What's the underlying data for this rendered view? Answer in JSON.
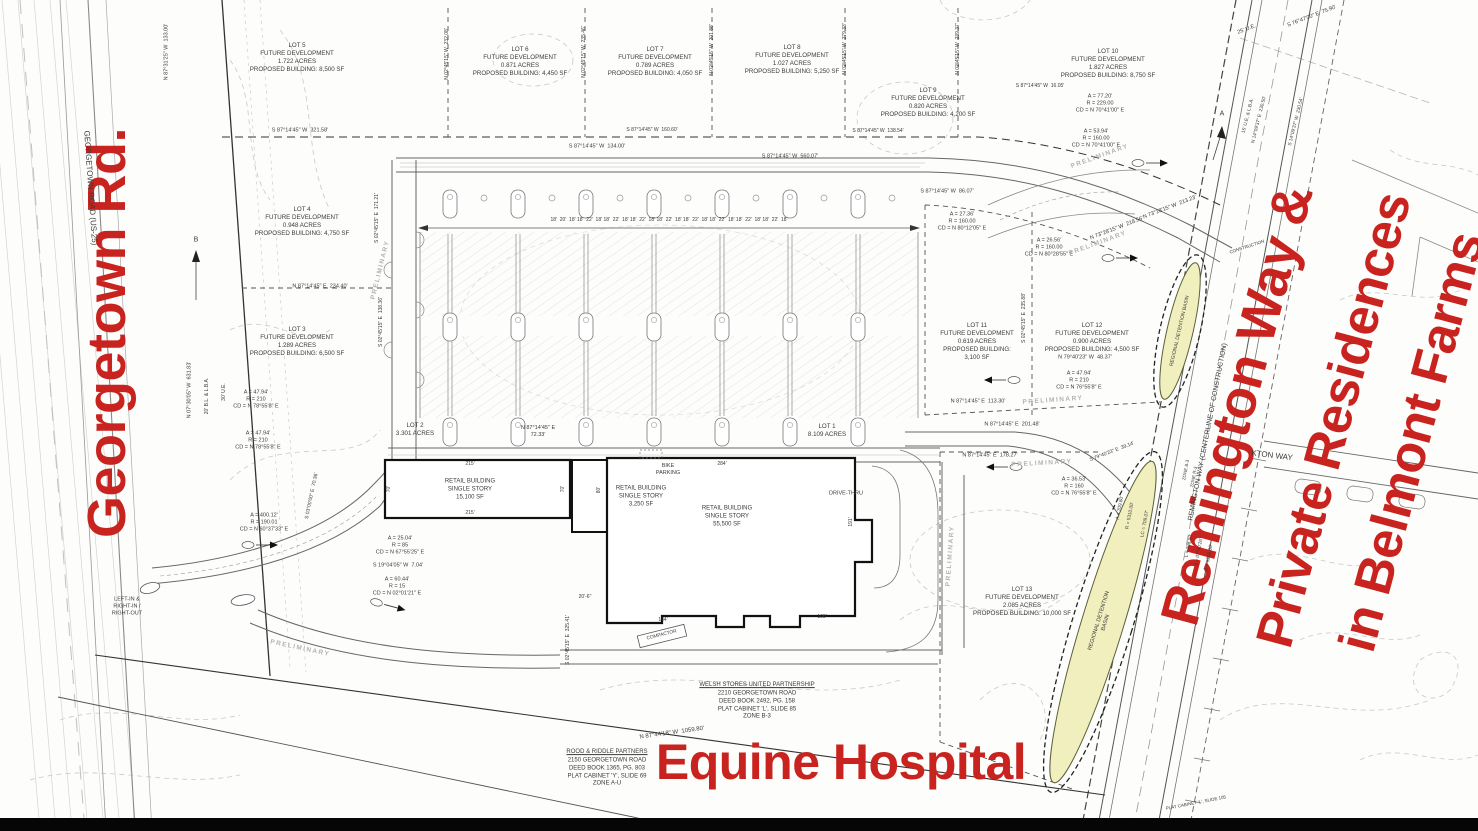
{
  "annotations": {
    "georgetown": "Georgetown Rd.",
    "remington_1": "Remington Way &",
    "remington_2": "Private Residences",
    "remington_3": "in Belmont Farms",
    "equine": "Equine Hospital",
    "color": "#c8231e"
  },
  "texts": [
    {
      "n": "road-label-georgetown",
      "t": "GEORGETOWN ROAD (US-25)",
      "x": 90,
      "y": 188,
      "r": 86,
      "s": 8
    },
    {
      "n": "road-label-remington",
      "t": "REMINGTON WAY (CENTERLINE OF CONSTRUCTION)",
      "x": 1208,
      "y": 432,
      "r": -79,
      "s": 7
    },
    {
      "n": "road-label-side-street",
      "t": "KTON WAY",
      "x": 1272,
      "y": 456,
      "r": 7,
      "s": 8
    },
    {
      "n": "lot5-label",
      "t": "LOT 5\nFUTURE DEVELOPMENT\n1.722 ACRES\nPROPOSED BUILDING: 8,500 SF",
      "x": 297,
      "y": 58
    },
    {
      "n": "lot6-label",
      "t": "LOT 6\nFUTURE DEVELOPMENT\n0.871 ACRES\nPROPOSED BUILDING: 4,450 SF",
      "x": 520,
      "y": 62
    },
    {
      "n": "lot7-label",
      "t": "LOT 7\nFUTURE DEVELOPMENT\n0.789 ACRES\nPROPOSED BUILDING: 4,050 SF",
      "x": 655,
      "y": 62
    },
    {
      "n": "lot8-label",
      "t": "LOT 8\nFUTURE DEVELOPMENT\n1.027 ACRES\nPROPOSED BUILDING: 5,250 SF",
      "x": 792,
      "y": 60
    },
    {
      "n": "lot9-label",
      "t": "LOT 9\nFUTURE DEVELOPMENT\n0.820 ACRES\nPROPOSED BUILDING: 4,200 SF",
      "x": 928,
      "y": 103
    },
    {
      "n": "lot10-label",
      "t": "LOT 10\nFUTURE DEVELOPMENT\n1.827 ACRES\nPROPOSED BUILDING: 8,750 SF",
      "x": 1108,
      "y": 64
    },
    {
      "n": "lot4-label",
      "t": "LOT 4\nFUTURE DEVELOPMENT\n0.948 ACRES\nPROPOSED BUILDING: 4,750 SF",
      "x": 302,
      "y": 222
    },
    {
      "n": "lot3-label",
      "t": "LOT 3\nFUTURE DEVELOPMENT\n1.289 ACRES\nPROPOSED BUILDING: 6,500 SF",
      "x": 297,
      "y": 342
    },
    {
      "n": "lot11-label",
      "t": "LOT 11\nFUTURE DEVELOPMENT\n0.619 ACRES\nPROPOSED BUILDING:\n3,100 SF",
      "x": 977,
      "y": 342
    },
    {
      "n": "lot12-label",
      "t": "LOT 12\nFUTURE DEVELOPMENT\n0.900 ACRES\nPROPOSED BUILDING: 4,500 SF",
      "x": 1092,
      "y": 338
    },
    {
      "n": "lot13-label",
      "t": "LOT 13\nFUTURE DEVELOPMENT\n2.085 ACRES\nPROPOSED BUILDING: 10,000 SF",
      "x": 1022,
      "y": 602
    },
    {
      "n": "lot2-label",
      "t": "LOT 2\n3.301 ACRES",
      "x": 415,
      "y": 430
    },
    {
      "n": "lot1-label",
      "t": "LOT 1\n8.109 ACRES",
      "x": 827,
      "y": 431
    },
    {
      "n": "building1-label",
      "t": "RETAIL BUILDING\nSINGLE STORY\n15,100 SF",
      "x": 470,
      "y": 490,
      "s": 6
    },
    {
      "n": "building2-label",
      "t": "RETAIL BUILDING\nSINGLE STORY\n3,250 SF",
      "x": 641,
      "y": 497,
      "s": 6
    },
    {
      "n": "building3-label",
      "t": "RETAIL BUILDING\nSINGLE STORY\n55,500 SF",
      "x": 727,
      "y": 517,
      "s": 6
    },
    {
      "n": "bike-parking-label",
      "t": "BIKE\nPARKING",
      "x": 668,
      "y": 470,
      "s": 5.5
    },
    {
      "n": "drive-thru-label",
      "t": "DRIVE-THRU",
      "x": 846,
      "y": 494,
      "s": 5.5
    },
    {
      "n": "compactor-label",
      "t": "COMPACTOR",
      "x": 662,
      "y": 636,
      "r": -14,
      "s": 4.8
    },
    {
      "n": "left-in-right-out-label",
      "t": "LEFT-IN &\nRIGHT-IN /\nRIGHT-OUT",
      "x": 127,
      "y": 607,
      "s": 5.5
    },
    {
      "n": "owner-a-title",
      "t": "WELSH STORES UNITED PARTNERSHIP",
      "x": 757,
      "y": 686,
      "s": 6,
      "u": 1
    },
    {
      "n": "owner-a-body",
      "t": "2210 GEORGETOWN ROAD\nDEED BOOK 2492, PG. 158\nPLAT CABINET 'L', SLIDE 85\nZONE B-3",
      "x": 757,
      "y": 706,
      "s": 6
    },
    {
      "n": "owner-b-title",
      "t": "ROOD & RIDDLE PARTNERS",
      "x": 607,
      "y": 753,
      "s": 6,
      "u": 1
    },
    {
      "n": "owner-b-body",
      "t": "2150 GEORGETOWN ROAD\nDEED BOOK 1365, PG. 803\nPLAT CABINET 'Y', SLIDE 69\nZONE A-U",
      "x": 607,
      "y": 773,
      "s": 6
    },
    {
      "n": "basin1-label",
      "t": "REGIONAL DETENTION BASIN",
      "x": 1180,
      "y": 331,
      "r": -77,
      "s": 5
    },
    {
      "n": "basin2-label",
      "t": "REGIONAL DETENTION\nBASIN",
      "x": 1103,
      "y": 622,
      "r": -73,
      "s": 5.5
    },
    {
      "n": "parking-dim-string",
      "t": "18'  20'  18' 18'  22'  18' 18'  22'  18' 18'  22'  18' 18'  22'  18' 18'  22'  18' 18'  22'  18' 18'  22'  18' 18'  22'  18'",
      "x": 669,
      "y": 220,
      "s": 5
    },
    {
      "n": "dim-13300",
      "t": "N 87°31'25\" W  133.00'",
      "x": 167,
      "y": 52,
      "r": -90,
      "s": 5.5
    },
    {
      "n": "dim-63183",
      "t": "N 07°30'05\" W  631.83'",
      "x": 190,
      "y": 390,
      "r": -90,
      "s": 5.5
    },
    {
      "n": "dim-bl-lba",
      "t": "20' B.L. & L.B.A.",
      "x": 207,
      "y": 396,
      "r": -90,
      "s": 5
    },
    {
      "n": "dim-30-ue",
      "t": "30' U.E.",
      "x": 224,
      "y": 392,
      "r": -90,
      "s": 5
    },
    {
      "n": "dim-32158",
      "t": "S 87°14'45\" W  321.58'",
      "x": 300,
      "y": 131,
      "s": 5.5
    },
    {
      "n": "dim-13400",
      "t": "S 87°14'45\" W  134.00'",
      "x": 597,
      "y": 147,
      "s": 5.5
    },
    {
      "n": "dim-56007",
      "t": "S 87°14'45\" W  560.07'",
      "x": 790,
      "y": 157,
      "s": 5.5
    },
    {
      "n": "dim-16060",
      "t": "S 87°14'45\" W  160.60'",
      "x": 652,
      "y": 130,
      "s": 5
    },
    {
      "n": "dim-13854",
      "t": "S 87°14'45\" W  138.54'",
      "x": 878,
      "y": 131,
      "s": 5
    },
    {
      "n": "dim-23208",
      "t": "N 02°45'15\" W  232.08'",
      "x": 447,
      "y": 54,
      "r": -90,
      "s": 5
    },
    {
      "n": "dim-23546",
      "t": "N 02°45'15\" W  235.46'",
      "x": 584,
      "y": 52,
      "r": -90,
      "s": 5
    },
    {
      "n": "dim-20188",
      "t": "N 02°45'15\" W  201.88'",
      "x": 712,
      "y": 50,
      "r": -90,
      "s": 5
    },
    {
      "n": "dim-27933",
      "t": "N 02°45'15\" W  279.33'",
      "x": 845,
      "y": 49,
      "r": -90,
      "s": 5
    },
    {
      "n": "dim-23937",
      "t": "N 02°45'15\" W  239.37'",
      "x": 958,
      "y": 49,
      "r": -90,
      "s": 5
    },
    {
      "n": "dim-23440",
      "t": "N 87°14'45\" E  234.40'",
      "x": 320,
      "y": 287,
      "s": 5.5
    },
    {
      "n": "dim-17121",
      "t": "S 02°45'15\" E  171.21'",
      "x": 377,
      "y": 218,
      "r": -90,
      "s": 5
    },
    {
      "n": "dim-13836",
      "t": "S 02°45'15\" E  138.36'",
      "x": 381,
      "y": 322,
      "r": -90,
      "s": 5
    },
    {
      "n": "dim-23588",
      "t": "S 02°45'15\" E  235.88'",
      "x": 1024,
      "y": 318,
      "r": -90,
      "s": 5
    },
    {
      "n": "dim-32541",
      "t": "S 02°45'15\" E  325.41'",
      "x": 568,
      "y": 640,
      "r": -90,
      "s": 5
    },
    {
      "n": "dim-8607",
      "t": "S 87°14'45\" W  86.07'",
      "x": 947,
      "y": 192,
      "s": 5.5
    },
    {
      "n": "dim-1605",
      "t": "S 87°14'45\" W  16.05'",
      "x": 1040,
      "y": 86,
      "s": 5
    },
    {
      "n": "dim-21323",
      "t": "N 73°28'15\" W  213.23'",
      "x": 1170,
      "y": 208,
      "r": -21,
      "s": 5.5
    },
    {
      "n": "dim-21856",
      "t": "N 73°28'15\" W  218.56'",
      "x": 1117,
      "y": 229,
      "r": -21,
      "s": 5.5
    },
    {
      "n": "dim-11330",
      "t": "N 87°14'45\" E  113.30'",
      "x": 978,
      "y": 402,
      "s": 5.5
    },
    {
      "n": "dim-20148",
      "t": "N 87°14'45\" E  201.48'",
      "x": 1012,
      "y": 425,
      "s": 5.5
    },
    {
      "n": "dim-17827",
      "t": "N 87°14'45\" E  178.27'",
      "x": 990,
      "y": 456,
      "s": 5.5
    },
    {
      "n": "dim-4837",
      "t": "N 79°40'23\" W  48.37'",
      "x": 1085,
      "y": 358,
      "s": 5.5
    },
    {
      "n": "dim-3914",
      "t": "S 79°40'23\" E  39.14'",
      "x": 1112,
      "y": 452,
      "r": -21,
      "s": 5
    },
    {
      "n": "dim-7233",
      "t": "N 87°14'45\" E\n72.33'",
      "x": 538,
      "y": 432,
      "s": 5.5
    },
    {
      "n": "dim-105980",
      "t": "N 87°44'18\" W  1059.80'",
      "x": 672,
      "y": 734,
      "r": -8,
      "s": 6
    },
    {
      "n": "dim-7590",
      "t": "S 76°47'00\" E  75.90'",
      "x": 1312,
      "y": 17,
      "r": -21,
      "s": 5.5
    },
    {
      "n": "dim-25-ue",
      "t": "25' U.E.",
      "x": 1247,
      "y": 30,
      "r": -21,
      "s": 5.5
    },
    {
      "n": "dim-15-ue",
      "t": "15' U.E. & L.B.A.",
      "x": 1249,
      "y": 116,
      "r": -76,
      "s": 4.8
    },
    {
      "n": "dim-23050",
      "t": "N 14°09'37\" E  230.50'",
      "x": 1260,
      "y": 120,
      "r": -76,
      "s": 4.8
    },
    {
      "n": "dim-23054",
      "t": "S 14°09'37\" W  230.54'",
      "x": 1297,
      "y": 122,
      "r": -76,
      "s": 4.8
    },
    {
      "n": "curve-c1",
      "t": "A = 77.20'\nR = 229.00\nCD = N 70°41'00\" E",
      "x": 1100,
      "y": 104,
      "s": 5.5
    },
    {
      "n": "curve-c2",
      "t": "A = 53.94'\nR = 160.00\nCD = N 70°41'00\" E",
      "x": 1096,
      "y": 139,
      "s": 5.5
    },
    {
      "n": "curve-c3",
      "t": "A = 27.36'\nR = 160.00\nCD = N 80°12'05\" E",
      "x": 962,
      "y": 222,
      "s": 5.5
    },
    {
      "n": "curve-c4",
      "t": "A = 26.56'\nR = 160.00\nCD = N 80°28'55\" E",
      "x": 1049,
      "y": 248,
      "s": 5.5
    },
    {
      "n": "curve-c5",
      "t": "A = 47.94'\nR = 210\nCD = N 78°55'8\" E",
      "x": 256,
      "y": 400,
      "s": 5.5
    },
    {
      "n": "curve-c6",
      "t": "A = 47.94'\nR = 210\nCD = N 78°55'8\" E",
      "x": 258,
      "y": 441,
      "s": 5.5
    },
    {
      "n": "curve-c7",
      "t": "A = 400.12'\nR = 190.01\nCD = N 60°37'33\" E",
      "x": 264,
      "y": 523,
      "s": 5.5
    },
    {
      "n": "curve-c8",
      "t": "A = 25.04'\nR = 85\nCD = N 67°55'25\" E",
      "x": 400,
      "y": 546,
      "s": 5.5
    },
    {
      "n": "curve-c9",
      "t": "A = 60.44'\nR = 15\nCD = N 02°01'21\" E",
      "x": 397,
      "y": 587,
      "s": 5.5
    },
    {
      "n": "curve-c10",
      "t": "A = 47.94'\nR = 210\nCD = N 76°55'8\" E",
      "x": 1079,
      "y": 381,
      "s": 5.5
    },
    {
      "n": "curve-c11",
      "t": "A = 36.53'\nR = 160\nCD = N 76°55'8\" E",
      "x": 1074,
      "y": 487,
      "s": 5.5
    },
    {
      "n": "dim-704",
      "t": "S 19°04'05\" W  7.04'",
      "x": 398,
      "y": 566,
      "s": 5.5
    },
    {
      "n": "dim-7036",
      "t": "S 03°00'00\" E  70.36'",
      "x": 312,
      "y": 496,
      "r": -78,
      "s": 5
    },
    {
      "n": "watermark-preliminary-1",
      "t": "PRELIMINARY",
      "x": 381,
      "y": 270,
      "r": -76,
      "s": 6.5,
      "c": "wm"
    },
    {
      "n": "watermark-preliminary-2",
      "t": "PRELIMINARY",
      "x": 1100,
      "y": 157,
      "r": -20,
      "s": 6.5,
      "c": "wm"
    },
    {
      "n": "watermark-preliminary-3",
      "t": "PRELIMINARY",
      "x": 1098,
      "y": 244,
      "r": -20,
      "s": 6.5,
      "c": "wm"
    },
    {
      "n": "watermark-preliminary-4",
      "t": "PRELIMINARY",
      "x": 1053,
      "y": 401,
      "r": -4,
      "s": 6.5,
      "c": "wm"
    },
    {
      "n": "watermark-preliminary-5",
      "t": "PRELIMINARY",
      "x": 951,
      "y": 556,
      "r": -86,
      "s": 6.5,
      "c": "wm"
    },
    {
      "n": "watermark-preliminary-6",
      "t": "PRELIMINARY",
      "x": 1042,
      "y": 464,
      "r": -3,
      "s": 6.5,
      "c": "wm"
    },
    {
      "n": "watermark-preliminary-7",
      "t": "PRELIMINARY",
      "x": 300,
      "y": 649,
      "r": 12,
      "s": 6.5,
      "c": "wm"
    },
    {
      "n": "road-curve-a",
      "t": "A = 709.80'",
      "x": 1121,
      "y": 508,
      "r": -79,
      "s": 4.8
    },
    {
      "n": "road-curve-r",
      "t": "R = 5310.00'",
      "x": 1131,
      "y": 516,
      "r": -79,
      "s": 4.8
    },
    {
      "n": "road-curve-lc",
      "t": "LC = 709.07'",
      "x": 1146,
      "y": 524,
      "r": -79,
      "s": 4.8
    },
    {
      "n": "road-curve2-l",
      "t": "L = 708.50'",
      "x": 1190,
      "y": 546,
      "r": -79,
      "s": 4.8
    },
    {
      "n": "road-curve2-d",
      "t": "Δ = 07°40'26\"",
      "x": 1200,
      "y": 552,
      "r": -79,
      "s": 4.8
    },
    {
      "n": "road-curve2-r",
      "t": "R = 5289.00'",
      "x": 1210,
      "y": 558,
      "r": -79,
      "s": 4.8
    },
    {
      "n": "zone-b3-label",
      "t": "ZONE B-3",
      "x": 1186,
      "y": 470,
      "r": -79,
      "s": 4.5
    },
    {
      "n": "zone-r3-label",
      "t": "ZONE R-3",
      "x": 1194,
      "y": 477,
      "r": -79,
      "s": 4.5
    },
    {
      "n": "construction-label",
      "t": "CONSTRUCTION",
      "x": 1247,
      "y": 247,
      "r": -18,
      "s": 4.5
    },
    {
      "n": "plat-cabinet-slide-label",
      "t": "PLAT CABINET 'L', SLIDE 105",
      "x": 1196,
      "y": 803,
      "r": -11,
      "s": 4.5
    },
    {
      "n": "matchline-b",
      "t": "B",
      "x": 196,
      "y": 240,
      "s": 7
    },
    {
      "n": "matchline-a",
      "t": "A",
      "x": 1222,
      "y": 114,
      "s": 7
    },
    {
      "n": "bldg-dim-215-top",
      "t": "215'",
      "x": 470,
      "y": 464,
      "s": 5
    },
    {
      "n": "bldg-dim-215-bot",
      "t": "215'",
      "x": 470,
      "y": 513,
      "s": 5
    },
    {
      "n": "bldg-dim-70-left",
      "t": "70'",
      "x": 389,
      "y": 489,
      "r": -90,
      "s": 5
    },
    {
      "n": "bldg-dim-70-right",
      "t": "70'",
      "x": 563,
      "y": 489,
      "r": -90,
      "s": 5
    },
    {
      "n": "bldg-dim-80",
      "t": "80'",
      "x": 599,
      "y": 490,
      "r": -90,
      "s": 5
    },
    {
      "n": "bldg-dim-284",
      "t": "284'",
      "x": 722,
      "y": 464,
      "s": 5
    },
    {
      "n": "bldg-dim-191",
      "t": "191'",
      "x": 851,
      "y": 522,
      "r": -90,
      "s": 5
    },
    {
      "n": "bldg-dim-134",
      "t": "134'",
      "x": 663,
      "y": 620,
      "s": 5
    },
    {
      "n": "bldg-dim-108",
      "t": "108'",
      "x": 822,
      "y": 617,
      "s": 5
    },
    {
      "n": "bldg-dim-20-6",
      "t": "20'-6\"",
      "x": 585,
      "y": 597,
      "s": 5
    }
  ]
}
